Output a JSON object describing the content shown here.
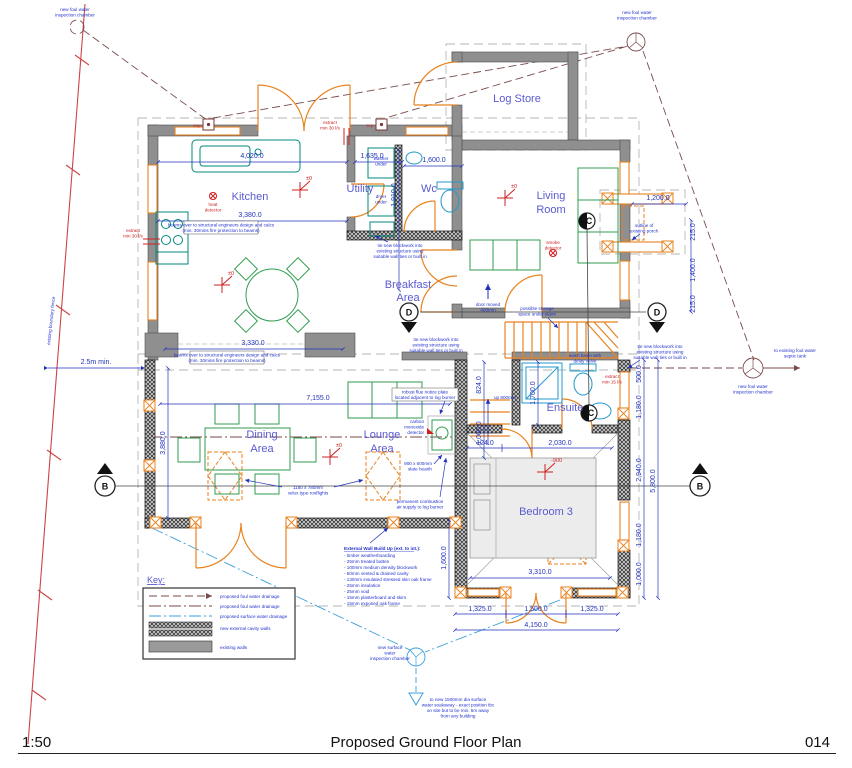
{
  "title_block": {
    "scale": "1:50",
    "title": "Proposed Ground Floor Plan",
    "number": "014"
  },
  "rooms": {
    "kitchen": [
      "Kitchen"
    ],
    "utility": [
      "Utility"
    ],
    "wc": [
      "Wc"
    ],
    "log_store": [
      "Log Store"
    ],
    "living_room": [
      "Living",
      "Room"
    ],
    "breakfast": [
      "Breakfast",
      "Area"
    ],
    "dining": [
      "Dining",
      "Area"
    ],
    "lounge": [
      "Lounge",
      "Area"
    ],
    "ensuite": [
      "Ensuite"
    ],
    "bedroom3": [
      "Bedroom 3"
    ]
  },
  "dims": {
    "top_kitchen": "4,020.0",
    "top_utility": "1,635.0",
    "top_wc": "1,600.0",
    "kitchen_width": "3,380.0",
    "kitchen_south": "3,330.0",
    "wc_height": "1,910.0",
    "porch_width": "1,200.0",
    "porch_side_a": "215.0",
    "porch_depth": "1,400.0",
    "porch_side_b": "215.0",
    "boundary_gap": "2.5m min.",
    "extension_width": "7,155.0",
    "extension_left": "3,880.0",
    "hall_a": "824.0",
    "hall_b": "1,060.0",
    "ensuite_depth": "1,700.0",
    "bed_top_a": "124.0",
    "bed_top_b": "2,030.0",
    "bed_width": "3,310.0",
    "bed_left": "1,600.0",
    "bed_bottom_a": "1,325.0",
    "bed_bottom_b": "1,500.0",
    "bed_bottom_c": "1,325.0",
    "bed_bottom_total": "4,150.0",
    "right_a": "500.0",
    "right_b": "1,180.0",
    "right_c": "2,940.0",
    "right_d": "1,180.0",
    "right_e": "1,000.0",
    "right_total": "5,800.0"
  },
  "levels": {
    "zero": "±0",
    "minus900": "-900"
  },
  "markers": {
    "b": "B",
    "c": "C",
    "d": "D"
  },
  "notes": {
    "foul_chamber": [
      "new foul water",
      "inspection chamber"
    ],
    "surface_chamber": [
      "new surface",
      "water",
      "inspection chamber"
    ],
    "septic": [
      "to existing foul water",
      "septic tank"
    ],
    "soakaway": [
      "to new 1500mm dia surface",
      "water soakaway - exact position tbc",
      "on site but to be min. 5m away",
      "from any building"
    ],
    "boundary_fence": "existing boundary fence",
    "porch": [
      "outline of",
      "existing porch"
    ],
    "beams": [
      "beams over to structural engineers design and calcs",
      "(min. 30mins fire protection to beams)"
    ],
    "blockwork": [
      "tie new blockwork into",
      "existing structure using",
      "suitable wall ties or built in"
    ],
    "storage_stairs": [
      "possible storage",
      "space under stairs"
    ],
    "door_moved": [
      "door moved",
      "400mm"
    ],
    "flue_plate": [
      "robust flue notice plate",
      "located adjacent to log burner"
    ],
    "co_detector": [
      "carbon",
      "monoxide",
      "detector"
    ],
    "velux": [
      "1180 x 780mm",
      "velux type rooflights"
    ],
    "hearth": [
      "900 x 600mm",
      "slate hearth"
    ],
    "combustion": [
      "permanent combustion",
      "air supply to log burner"
    ],
    "heat_detector": [
      "heat",
      "detector"
    ],
    "smoke_detector": [
      "smoke",
      "detector"
    ],
    "extract30": [
      "extract",
      "min 30 l/s"
    ],
    "extract15": [
      "extract",
      "min 15 l/s"
    ],
    "svp": "svp",
    "washer": [
      "washer",
      "under"
    ],
    "dryer": [
      "dryer",
      "under"
    ],
    "basin": [
      "wash basin with",
      "delay valve"
    ],
    "min_gap": "2.5m min.",
    "up800": "up 800mm"
  },
  "key": {
    "title": "Key:",
    "items": [
      {
        "label": "proposed foul water drainage"
      },
      {
        "label": "proposed foul water drainage"
      },
      {
        "label": "proposed surface water drainage"
      },
      {
        "label": "new external cavity walls"
      },
      {
        "label": "existing walls"
      }
    ]
  },
  "wall_buildup": {
    "title": "External Wall Build Up (ext. to int.):",
    "lines": [
      "- timber weatherboarding",
      "- 25mm treated batten",
      "- 100mm medium density blockwork",
      "- 50mm vented & drained cavity",
      "- 130mm insulated stressed skin oak frame",
      "- 25mm insulation",
      "- 25mm void",
      "- 15mm plasterboard and skim",
      "- 15mm exposed oak frame"
    ]
  },
  "colors": {
    "walls_existing": "#8f8f8f",
    "joinery_orange": "#e8821e",
    "furniture_green": "#2f9e4f",
    "fixtures_teal": "#00897b",
    "dimension_blue": "#2233bb",
    "label_blue": "#5a5ad0",
    "alert_red": "#cc2222",
    "foul_drain_brown": "#7a4a4a",
    "surface_drain_blue": "#3aa0d8",
    "fence_red": "#cc4444"
  }
}
